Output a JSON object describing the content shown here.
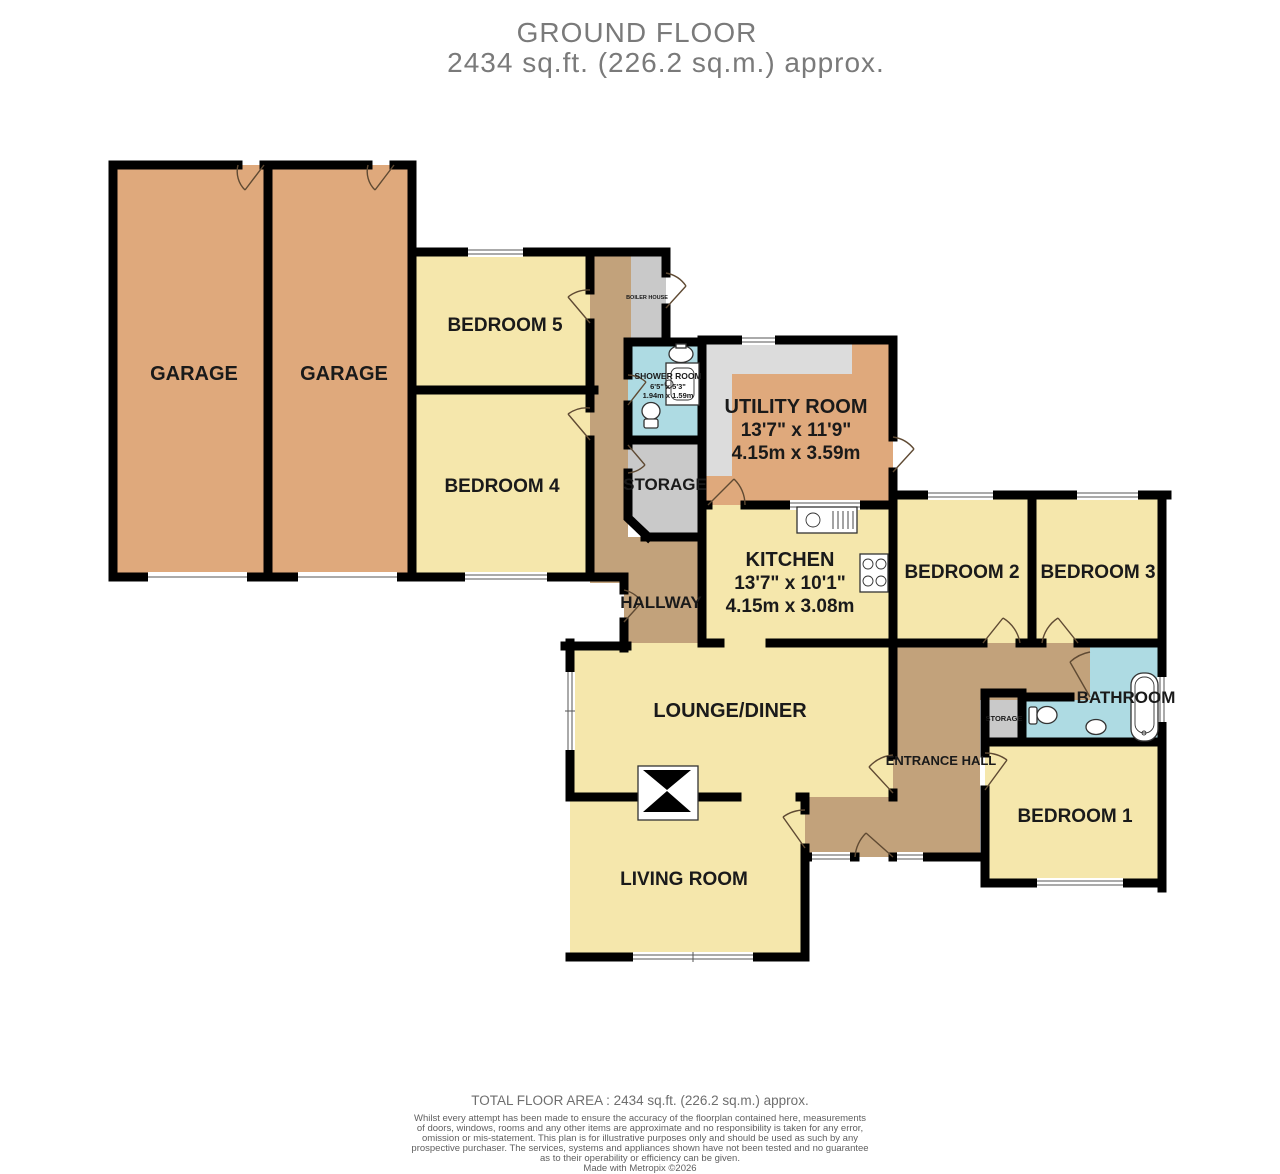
{
  "title": {
    "line1": "GROUND FLOOR",
    "line2": "2434 sq.ft. (226.2 sq.m.) approx."
  },
  "colors": {
    "garage": "#dfa97c",
    "room": "#f5e7ac",
    "hall": "#c2a27b",
    "storage": "#c9c9c9",
    "wet": "#aedbe3",
    "counter": "#dcdcdc",
    "wall": "#000000",
    "label": "#1a1a1a",
    "title_gray": "#7a7a7a"
  },
  "rooms": {
    "garage_left": {
      "label": "GARAGE"
    },
    "garage_right": {
      "label": "GARAGE"
    },
    "bedroom5": {
      "label": "BEDROOM 5"
    },
    "bedroom4": {
      "label": "BEDROOM 4"
    },
    "boiler_house": {
      "label": "BOILER HOUSE"
    },
    "shower_room": {
      "label": "SHOWER ROOM",
      "dims_imperial": "6'5\" x 5'3\"",
      "dims_metric": "1.94m x 1.59m"
    },
    "storage": {
      "label": "STORAGE"
    },
    "hallway": {
      "label": "HALLWAY"
    },
    "utility_room": {
      "label": "UTILITY ROOM",
      "dims_imperial": "13'7\" x 11'9\"",
      "dims_metric": "4.15m x 3.59m"
    },
    "kitchen": {
      "label": "KITCHEN",
      "dims_imperial": "13'7\" x 10'1\"",
      "dims_metric": "4.15m x 3.08m"
    },
    "bedroom2": {
      "label": "BEDROOM 2"
    },
    "bedroom3": {
      "label": "BEDROOM 3"
    },
    "bathroom": {
      "label": "BATHROOM"
    },
    "storage_small": {
      "label": "STORAGE"
    },
    "entrance_hall": {
      "label": "ENTRANCE HALL"
    },
    "bedroom1": {
      "label": "BEDROOM 1"
    },
    "lounge_diner": {
      "label": "LOUNGE/DINER"
    },
    "living_room": {
      "label": "LIVING ROOM"
    }
  },
  "footer": {
    "total_area": "TOTAL FLOOR AREA : 2434 sq.ft. (226.2 sq.m.) approx.",
    "disclaimer": [
      "Whilst every attempt has been made to ensure the accuracy of the floorplan contained here, measurements",
      "of doors, windows, rooms and any other items are approximate and no responsibility is taken for any error,",
      "omission or mis-statement. This plan is for illustrative purposes only and should be used as such by any",
      "prospective purchaser. The services, systems and appliances shown have not been tested and no guarantee",
      "as to their operability or efficiency can be given."
    ],
    "credit": "Made with Metropix ©2026"
  }
}
